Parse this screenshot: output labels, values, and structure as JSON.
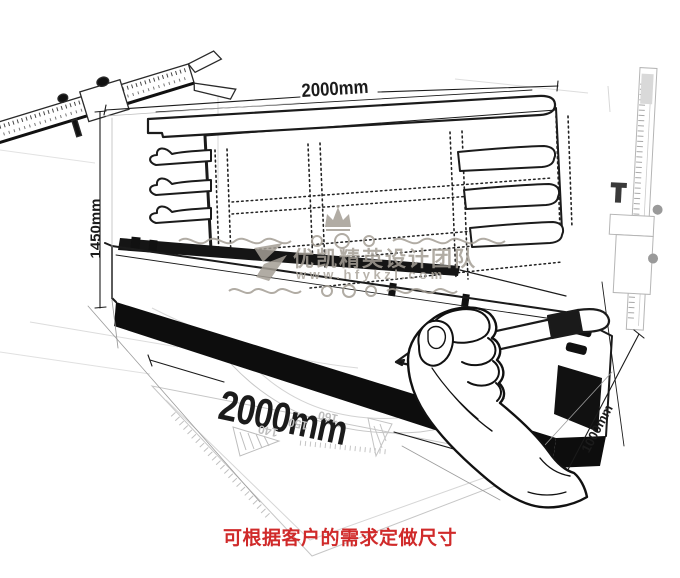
{
  "canvas": {
    "width": 680,
    "height": 578,
    "background": "#ffffff"
  },
  "labels": {
    "top_width": "2000mm",
    "left_height": "1450mm",
    "front_width": "2000mm",
    "side_depth": "1000mm"
  },
  "watermark": {
    "team_name": "优凯精英设计团队",
    "website": "www.hfykzl.com"
  },
  "caption": "可根据客户的需求定做尺寸",
  "protractor_numbers": [
    "140",
    "150",
    "160"
  ],
  "colors": {
    "ink": "#1b1b1b",
    "faint_sketch": "#c9c9c9",
    "watermark_gray": "#a49e95",
    "caption_red": "#d02a2a"
  }
}
